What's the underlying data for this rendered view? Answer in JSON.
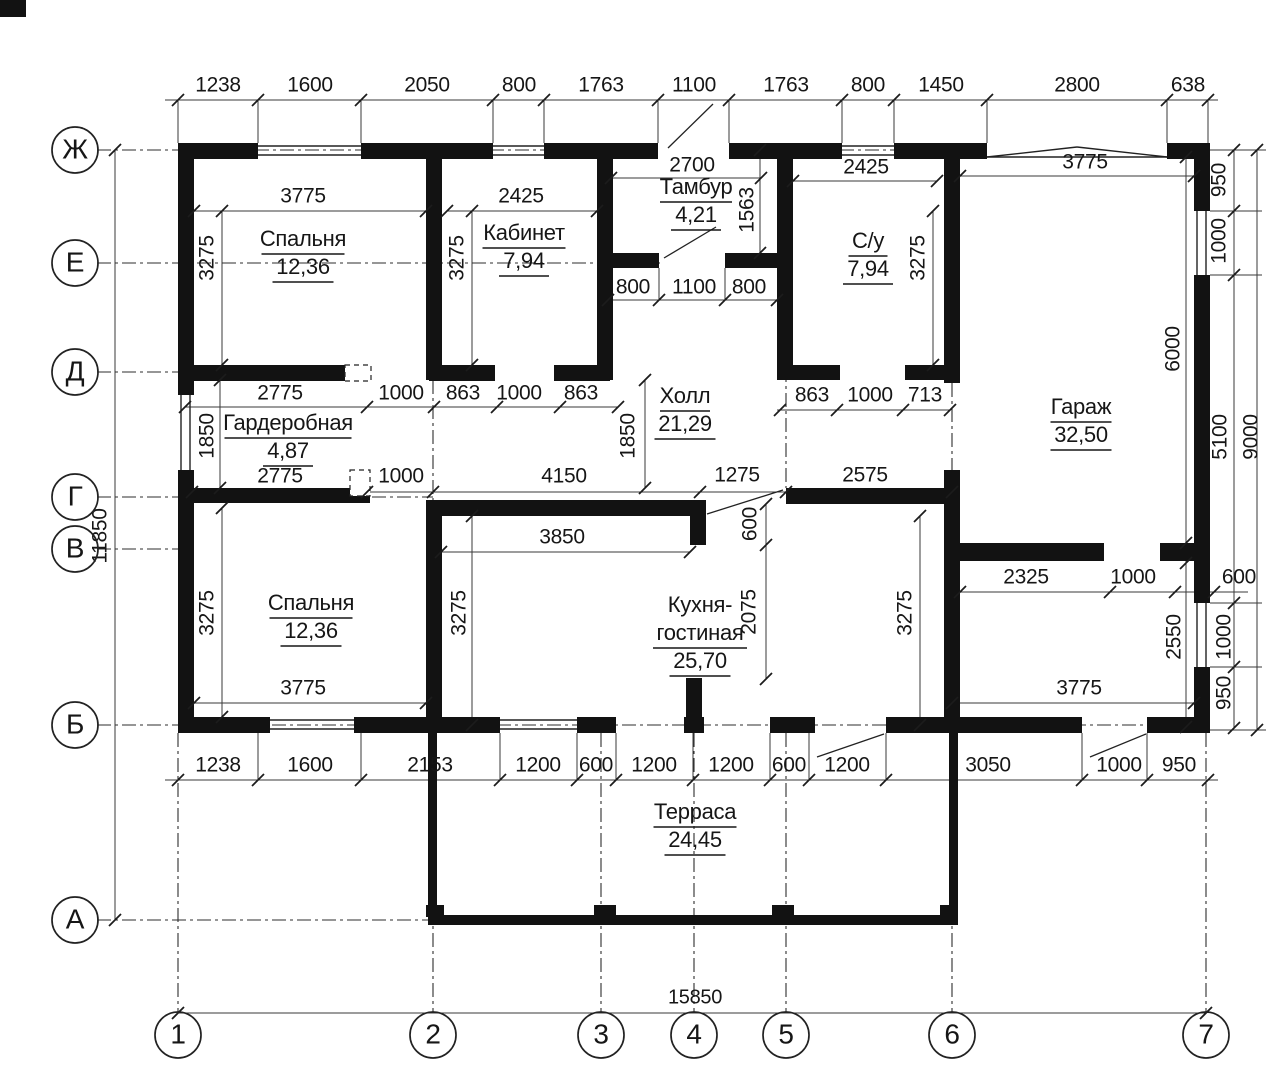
{
  "colors": {
    "wall": "#121212",
    "line": "#3a3a3a",
    "axis": "#2d2d2d",
    "text": "#161616",
    "bg": "#ffffff"
  },
  "rooms": [
    {
      "lines": [
        "Спальня"
      ],
      "area": "12,36",
      "x": 303,
      "y": 240
    },
    {
      "lines": [
        "Кабинет"
      ],
      "area": "7,94",
      "x": 524,
      "y": 234
    },
    {
      "lines": [
        "Тамбур"
      ],
      "area": "4,21",
      "x": 696,
      "y": 188
    },
    {
      "lines": [
        "С/у"
      ],
      "area": "7,94",
      "x": 868,
      "y": 242
    },
    {
      "lines": [
        "Гараж"
      ],
      "area": "32,50",
      "x": 1081,
      "y": 408
    },
    {
      "lines": [
        "Холл"
      ],
      "area": "21,29",
      "x": 685,
      "y": 397
    },
    {
      "lines": [
        "Гардеробная"
      ],
      "area": "4,87",
      "x": 288,
      "y": 424
    },
    {
      "lines": [
        "Спальня"
      ],
      "area": "12,36",
      "x": 311,
      "y": 604
    },
    {
      "lines": [
        "Кухня-",
        "гостиная"
      ],
      "area": "25,70",
      "x": 700,
      "y": 606
    },
    {
      "lines": [
        "Терраса"
      ],
      "area": "24,45",
      "x": 695,
      "y": 813
    }
  ],
  "axes": {
    "rows": [
      {
        "l": "Ж",
        "y": 150
      },
      {
        "l": "Е",
        "y": 263
      },
      {
        "l": "Д",
        "y": 372
      },
      {
        "l": "Г",
        "y": 497
      },
      {
        "l": "В",
        "y": 549
      },
      {
        "l": "Б",
        "y": 725
      },
      {
        "l": "А",
        "y": 920
      }
    ],
    "cols": [
      {
        "l": "1",
        "x": 178
      },
      {
        "l": "2",
        "x": 433
      },
      {
        "l": "3",
        "x": 601
      },
      {
        "l": "4",
        "x": 694
      },
      {
        "l": "5",
        "x": 786
      },
      {
        "l": "6",
        "x": 952
      },
      {
        "l": "7",
        "x": 1206
      }
    ]
  },
  "dims": [
    {
      "t": "1238",
      "x": 218,
      "y": 86
    },
    {
      "t": "1600",
      "x": 310,
      "y": 86
    },
    {
      "t": "2050",
      "x": 427,
      "y": 86
    },
    {
      "t": "800",
      "x": 519,
      "y": 86
    },
    {
      "t": "1763",
      "x": 601,
      "y": 86
    },
    {
      "t": "1100",
      "x": 694,
      "y": 86
    },
    {
      "t": "1763",
      "x": 786,
      "y": 86
    },
    {
      "t": "800",
      "x": 868,
      "y": 86
    },
    {
      "t": "1450",
      "x": 941,
      "y": 86
    },
    {
      "t": "2800",
      "x": 1077,
      "y": 86
    },
    {
      "t": "638",
      "x": 1188,
      "y": 86
    },
    {
      "t": "3775",
      "x": 303,
      "y": 197
    },
    {
      "t": "2425",
      "x": 521,
      "y": 197
    },
    {
      "t": "2700",
      "x": 692,
      "y": 166
    },
    {
      "t": "2425",
      "x": 866,
      "y": 168
    },
    {
      "t": "3775",
      "x": 1085,
      "y": 163
    },
    {
      "t": "3275",
      "x": 208,
      "y": 258,
      "r": 1
    },
    {
      "t": "3275",
      "x": 458,
      "y": 258,
      "r": 1
    },
    {
      "t": "1563",
      "x": 748,
      "y": 210,
      "r": 1
    },
    {
      "t": "3275",
      "x": 919,
      "y": 258,
      "r": 1
    },
    {
      "t": "950",
      "x": 1220,
      "y": 180,
      "r": 1
    },
    {
      "t": "1000",
      "x": 1220,
      "y": 241,
      "r": 1
    },
    {
      "t": "6000",
      "x": 1174,
      "y": 349,
      "r": 1
    },
    {
      "t": "5100",
      "x": 1221,
      "y": 437,
      "r": 1
    },
    {
      "t": "9000",
      "x": 1252,
      "y": 437,
      "r": 1
    },
    {
      "t": "11850",
      "x": 101,
      "y": 536,
      "r": 1
    },
    {
      "t": "800",
      "x": 633,
      "y": 288
    },
    {
      "t": "1100",
      "x": 694,
      "y": 288
    },
    {
      "t": "800",
      "x": 749,
      "y": 288
    },
    {
      "t": "2775",
      "x": 280,
      "y": 394
    },
    {
      "t": "1000",
      "x": 401,
      "y": 394
    },
    {
      "t": "863",
      "x": 463,
      "y": 394
    },
    {
      "t": "1000",
      "x": 519,
      "y": 394
    },
    {
      "t": "863",
      "x": 581,
      "y": 394
    },
    {
      "t": "863",
      "x": 812,
      "y": 396
    },
    {
      "t": "1000",
      "x": 870,
      "y": 396
    },
    {
      "t": "713",
      "x": 925,
      "y": 396
    },
    {
      "t": "1850",
      "x": 208,
      "y": 436,
      "r": 1
    },
    {
      "t": "1850",
      "x": 629,
      "y": 436,
      "r": 1
    },
    {
      "t": "2775",
      "x": 280,
      "y": 477
    },
    {
      "t": "1000",
      "x": 401,
      "y": 477
    },
    {
      "t": "4150",
      "x": 564,
      "y": 477
    },
    {
      "t": "1275",
      "x": 737,
      "y": 476
    },
    {
      "t": "2575",
      "x": 865,
      "y": 476
    },
    {
      "t": "3850",
      "x": 562,
      "y": 538
    },
    {
      "t": "600",
      "x": 751,
      "y": 524,
      "r": 1
    },
    {
      "t": "2075",
      "x": 750,
      "y": 612,
      "r": 1
    },
    {
      "t": "3275",
      "x": 208,
      "y": 613,
      "r": 1
    },
    {
      "t": "3275",
      "x": 460,
      "y": 613,
      "r": 1
    },
    {
      "t": "3275",
      "x": 906,
      "y": 613,
      "r": 1
    },
    {
      "t": "3775",
      "x": 303,
      "y": 689
    },
    {
      "t": "3775",
      "x": 1079,
      "y": 689
    },
    {
      "t": "2325",
      "x": 1026,
      "y": 578
    },
    {
      "t": "1000",
      "x": 1133,
      "y": 578
    },
    {
      "t": "600",
      "x": 1239,
      "y": 578
    },
    {
      "t": "2550",
      "x": 1175,
      "y": 637,
      "r": 1
    },
    {
      "t": "1000",
      "x": 1225,
      "y": 637,
      "r": 1
    },
    {
      "t": "950",
      "x": 1225,
      "y": 693,
      "r": 1
    },
    {
      "t": "1238",
      "x": 218,
      "y": 766
    },
    {
      "t": "1600",
      "x": 310,
      "y": 766
    },
    {
      "t": "2153",
      "x": 430,
      "y": 766
    },
    {
      "t": "1200",
      "x": 538,
      "y": 766
    },
    {
      "t": "600",
      "x": 596,
      "y": 766
    },
    {
      "t": "1200",
      "x": 654,
      "y": 766
    },
    {
      "t": "1200",
      "x": 731,
      "y": 766
    },
    {
      "t": "600",
      "x": 789,
      "y": 766
    },
    {
      "t": "1200",
      "x": 847,
      "y": 766
    },
    {
      "t": "3050",
      "x": 988,
      "y": 766
    },
    {
      "t": "1000",
      "x": 1119,
      "y": 766
    },
    {
      "t": "950",
      "x": 1179,
      "y": 766
    },
    {
      "t": "15850",
      "x": 695,
      "y": 998
    }
  ],
  "walls": [
    [
      0,
      0,
      26,
      17
    ],
    [
      178,
      143,
      80,
      16
    ],
    [
      361,
      143,
      132,
      16
    ],
    [
      544,
      143,
      114,
      16
    ],
    [
      729,
      143,
      113,
      16
    ],
    [
      894,
      143,
      93,
      16
    ],
    [
      1167,
      143,
      43,
      16
    ],
    [
      178,
      143,
      16,
      252
    ],
    [
      178,
      470,
      16,
      263
    ],
    [
      1194,
      143,
      16,
      68
    ],
    [
      1194,
      275,
      16,
      328
    ],
    [
      1194,
      667,
      16,
      66
    ],
    [
      178,
      717,
      92,
      16
    ],
    [
      354,
      717,
      146,
      16
    ],
    [
      577,
      717,
      39,
      16
    ],
    [
      684,
      717,
      20,
      16
    ],
    [
      770,
      717,
      45,
      16
    ],
    [
      886,
      717,
      196,
      16
    ],
    [
      1147,
      717,
      63,
      16
    ],
    [
      426,
      150,
      16,
      230
    ],
    [
      597,
      150,
      16,
      230
    ],
    [
      777,
      150,
      16,
      230
    ],
    [
      944,
      150,
      16,
      233
    ],
    [
      944,
      470,
      16,
      263
    ],
    [
      426,
      500,
      16,
      233
    ],
    [
      690,
      504,
      16,
      41
    ],
    [
      686,
      678,
      16,
      39
    ],
    [
      178,
      365,
      192,
      16
    ],
    [
      429,
      365,
      66,
      16
    ],
    [
      554,
      365,
      56,
      16
    ],
    [
      611,
      253,
      48,
      15
    ],
    [
      725,
      253,
      59,
      15
    ],
    [
      777,
      365,
      63,
      15
    ],
    [
      905,
      365,
      47,
      15
    ],
    [
      178,
      488,
      192,
      15
    ],
    [
      426,
      500,
      280,
      16
    ],
    [
      786,
      488,
      174,
      16
    ],
    [
      944,
      543,
      160,
      18
    ],
    [
      1160,
      543,
      44,
      18
    ],
    [
      428,
      733,
      9,
      184
    ],
    [
      949,
      733,
      9,
      184
    ],
    [
      428,
      915,
      530,
      10
    ],
    [
      426,
      905,
      18,
      12
    ],
    [
      594,
      905,
      22,
      12
    ],
    [
      772,
      905,
      22,
      12
    ],
    [
      940,
      905,
      18,
      12
    ]
  ],
  "win": [
    [
      258,
      146,
      361,
      146
    ],
    [
      258,
      155,
      361,
      155
    ],
    [
      493,
      146,
      544,
      146
    ],
    [
      493,
      155,
      544,
      155
    ],
    [
      842,
      146,
      894,
      146
    ],
    [
      842,
      155,
      894,
      155
    ],
    [
      987,
      157,
      1167,
      157
    ],
    [
      987,
      157,
      1077,
      147
    ],
    [
      1077,
      147,
      1167,
      157
    ],
    [
      181,
      395,
      181,
      470
    ],
    [
      190,
      395,
      190,
      470
    ],
    [
      1197,
      211,
      1197,
      275
    ],
    [
      1206,
      211,
      1206,
      275
    ],
    [
      1197,
      603,
      1197,
      667
    ],
    [
      1206,
      603,
      1206,
      667
    ],
    [
      270,
      720,
      354,
      720
    ],
    [
      270,
      729,
      354,
      729
    ],
    [
      500,
      720,
      577,
      720
    ],
    [
      500,
      729,
      577,
      729
    ]
  ],
  "thin": [
    [
      165,
      100,
      1218,
      100
    ],
    [
      194,
      211,
      426,
      211
    ],
    [
      447,
      211,
      597,
      211
    ],
    [
      611,
      178,
      761,
      178
    ],
    [
      793,
      181,
      937,
      181
    ],
    [
      960,
      176,
      1194,
      176
    ],
    [
      608,
      300,
      777,
      300
    ],
    [
      185,
      407,
      618,
      407
    ],
    [
      777,
      410,
      950,
      410
    ],
    [
      185,
      492,
      952,
      492
    ],
    [
      441,
      552,
      690,
      552
    ],
    [
      194,
      703,
      426,
      703
    ],
    [
      952,
      703,
      1194,
      703
    ],
    [
      960,
      592,
      1248,
      592
    ],
    [
      165,
      780,
      1218,
      780
    ],
    [
      178,
      1013,
      1206,
      1013
    ],
    [
      115,
      150,
      115,
      920
    ],
    [
      1234,
      150,
      1234,
      728
    ],
    [
      1257,
      150,
      1257,
      730
    ],
    [
      1186,
      157,
      1186,
      727
    ],
    [
      222,
      211,
      222,
      365
    ],
    [
      472,
      211,
      472,
      365
    ],
    [
      760,
      150,
      760,
      253
    ],
    [
      933,
      211,
      933,
      365
    ],
    [
      220,
      380,
      220,
      488
    ],
    [
      645,
      380,
      645,
      488
    ],
    [
      222,
      508,
      222,
      717
    ],
    [
      472,
      516,
      472,
      725
    ],
    [
      920,
      516,
      920,
      725
    ],
    [
      766,
      504,
      766,
      679
    ],
    [
      178,
      100,
      178,
      143
    ],
    [
      258,
      100,
      258,
      143
    ],
    [
      361,
      100,
      361,
      143
    ],
    [
      493,
      100,
      493,
      143
    ],
    [
      544,
      100,
      544,
      143
    ],
    [
      658,
      100,
      658,
      143
    ],
    [
      729,
      100,
      729,
      143
    ],
    [
      842,
      100,
      842,
      143
    ],
    [
      894,
      100,
      894,
      143
    ],
    [
      987,
      100,
      987,
      143
    ],
    [
      1167,
      100,
      1167,
      143
    ],
    [
      1208,
      100,
      1208,
      143
    ],
    [
      258,
      733,
      258,
      780
    ],
    [
      361,
      733,
      361,
      780
    ],
    [
      500,
      733,
      500,
      780
    ],
    [
      577,
      733,
      577,
      780
    ],
    [
      616,
      733,
      616,
      780
    ],
    [
      693,
      733,
      693,
      780
    ],
    [
      770,
      733,
      770,
      780
    ],
    [
      809,
      733,
      809,
      780
    ],
    [
      886,
      733,
      886,
      780
    ],
    [
      1082,
      733,
      1082,
      780
    ],
    [
      1147,
      733,
      1147,
      780
    ],
    [
      1210,
      211,
      1262,
      211
    ],
    [
      1210,
      275,
      1262,
      275
    ],
    [
      1210,
      603,
      1262,
      603
    ],
    [
      1210,
      667,
      1262,
      667
    ],
    [
      1210,
      150,
      1266,
      150
    ],
    [
      1210,
      730,
      1266,
      730
    ],
    [
      659,
      268,
      659,
      300
    ],
    [
      725,
      268,
      725,
      300
    ]
  ],
  "dashdot": [
    [
      97,
      150,
      180,
      150
    ],
    [
      255,
      150,
      364,
      150
    ],
    [
      490,
      150,
      547,
      150
    ],
    [
      840,
      150,
      897,
      150
    ],
    [
      97,
      263,
      660,
      263
    ],
    [
      97,
      372,
      187,
      372
    ],
    [
      97,
      497,
      433,
      497
    ],
    [
      97,
      549,
      185,
      549
    ],
    [
      97,
      725,
      1210,
      725
    ],
    [
      97,
      920,
      430,
      920
    ],
    [
      178,
      733,
      178,
      1012
    ],
    [
      433,
      733,
      433,
      1012
    ],
    [
      601,
      733,
      601,
      1012
    ],
    [
      694,
      733,
      694,
      1012
    ],
    [
      786,
      733,
      786,
      1012
    ],
    [
      952,
      733,
      952,
      1012
    ],
    [
      1206,
      733,
      1206,
      1012
    ],
    [
      433,
      380,
      433,
      500
    ],
    [
      786,
      268,
      786,
      488
    ],
    [
      952,
      383,
      952,
      470
    ]
  ],
  "ticks": [
    [
      178,
      100
    ],
    [
      258,
      100
    ],
    [
      361,
      100
    ],
    [
      493,
      100
    ],
    [
      544,
      100
    ],
    [
      658,
      100
    ],
    [
      729,
      100
    ],
    [
      842,
      100
    ],
    [
      894,
      100
    ],
    [
      987,
      100
    ],
    [
      1167,
      100
    ],
    [
      1208,
      100
    ],
    [
      194,
      211
    ],
    [
      426,
      211
    ],
    [
      447,
      211
    ],
    [
      597,
      211
    ],
    [
      611,
      178
    ],
    [
      761,
      178
    ],
    [
      793,
      181
    ],
    [
      937,
      181
    ],
    [
      960,
      176
    ],
    [
      1194,
      176
    ],
    [
      608,
      300
    ],
    [
      659,
      300
    ],
    [
      725,
      300
    ],
    [
      777,
      300
    ],
    [
      185,
      407
    ],
    [
      367,
      407
    ],
    [
      434,
      407
    ],
    [
      497,
      407
    ],
    [
      560,
      407
    ],
    [
      618,
      407
    ],
    [
      780,
      410
    ],
    [
      837,
      410
    ],
    [
      903,
      410
    ],
    [
      950,
      410
    ],
    [
      192,
      492
    ],
    [
      367,
      492
    ],
    [
      433,
      492
    ],
    [
      700,
      492
    ],
    [
      786,
      492
    ],
    [
      952,
      492
    ],
    [
      441,
      552
    ],
    [
      690,
      552
    ],
    [
      194,
      703
    ],
    [
      426,
      703
    ],
    [
      952,
      703
    ],
    [
      1194,
      703
    ],
    [
      960,
      592
    ],
    [
      1110,
      592
    ],
    [
      1175,
      592
    ],
    [
      1214,
      592
    ],
    [
      178,
      780
    ],
    [
      258,
      780
    ],
    [
      361,
      780
    ],
    [
      500,
      780
    ],
    [
      577,
      780
    ],
    [
      616,
      780
    ],
    [
      693,
      780
    ],
    [
      770,
      780
    ],
    [
      809,
      780
    ],
    [
      886,
      780
    ],
    [
      1082,
      780
    ],
    [
      1147,
      780
    ],
    [
      1208,
      780
    ],
    [
      178,
      1013
    ],
    [
      1206,
      1013
    ],
    [
      115,
      150
    ],
    [
      115,
      920
    ],
    [
      1234,
      150
    ],
    [
      1234,
      211
    ],
    [
      1234,
      275
    ],
    [
      1234,
      603
    ],
    [
      1234,
      667
    ],
    [
      1234,
      728
    ],
    [
      1257,
      150
    ],
    [
      1257,
      730
    ],
    [
      1186,
      157
    ],
    [
      1186,
      543
    ],
    [
      1186,
      563
    ],
    [
      1186,
      727
    ],
    [
      222,
      211
    ],
    [
      222,
      365
    ],
    [
      472,
      211
    ],
    [
      472,
      365
    ],
    [
      760,
      150
    ],
    [
      760,
      253
    ],
    [
      933,
      211
    ],
    [
      933,
      365
    ],
    [
      220,
      380
    ],
    [
      220,
      488
    ],
    [
      645,
      380
    ],
    [
      645,
      488
    ],
    [
      222,
      508
    ],
    [
      222,
      717
    ],
    [
      472,
      516
    ],
    [
      472,
      725
    ],
    [
      920,
      516
    ],
    [
      920,
      725
    ],
    [
      766,
      504
    ],
    [
      766,
      545
    ],
    [
      766,
      679
    ]
  ],
  "diag": [
    [
      668,
      148,
      713,
      104
    ],
    [
      707,
      514,
      783,
      490
    ],
    [
      817,
      757,
      884,
      734
    ],
    [
      1090,
      757,
      1146,
      734
    ],
    [
      664,
      258,
      716,
      227
    ]
  ],
  "dashedRects": [
    [
      345,
      365,
      26,
      16
    ],
    [
      350,
      470,
      20,
      26
    ]
  ]
}
